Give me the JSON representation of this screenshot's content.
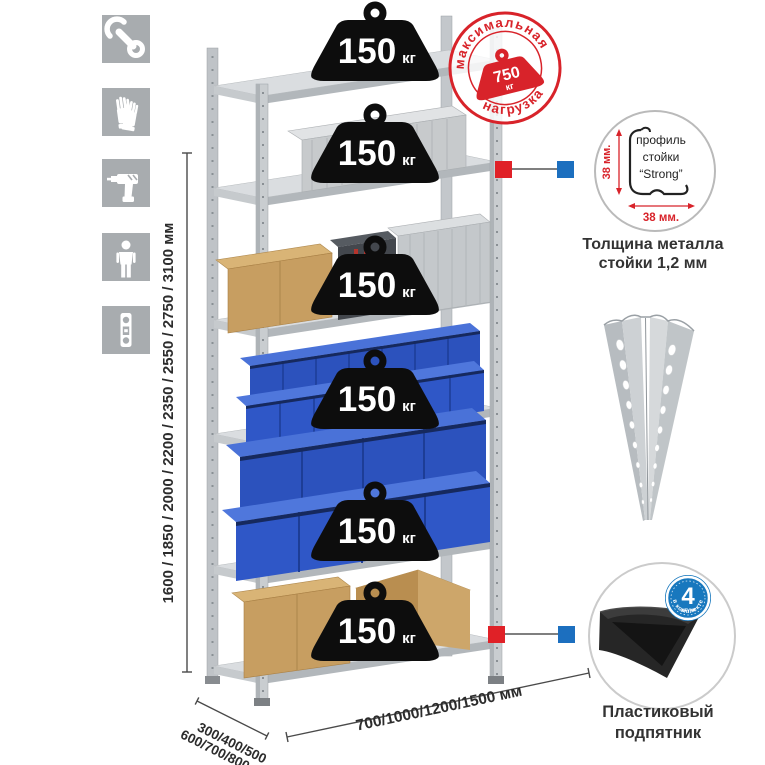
{
  "icons": [
    {
      "name": "wrench"
    },
    {
      "name": "work-gloves"
    },
    {
      "name": "drill"
    },
    {
      "name": "one-person-assembly"
    },
    {
      "name": "spirit-level"
    }
  ],
  "dimensions": {
    "height": "1600 / 1850 / 2000 / 2200 / 2350 / 2550 / 2750 / 3100 мм",
    "depth_line1": "300/400/500",
    "depth_line2": "600/700/800 мм",
    "width": "700/1000/1200/1500 мм"
  },
  "shelves": [
    {
      "load": "150",
      "unit": "кг"
    },
    {
      "load": "150",
      "unit": "кг"
    },
    {
      "load": "150",
      "unit": "кг"
    },
    {
      "load": "150",
      "unit": "кг"
    },
    {
      "load": "150",
      "unit": "кг"
    },
    {
      "load": "150",
      "unit": "кг"
    }
  ],
  "max_load_stamp": {
    "arc_top": "максимальная",
    "arc_bottom": "нагрузка",
    "value": "750",
    "unit": "кг"
  },
  "profile_callout": {
    "line1": "профиль",
    "line2": "стойки",
    "line3": "“Strong”",
    "dim_vertical": "38 мм.",
    "dim_horizontal": "38 мм.",
    "caption1": "Толщина металла",
    "caption2": "стойки 1,2 мм"
  },
  "foot_callout": {
    "badge_value": "4",
    "badge_unit": "штуки",
    "badge_arc": "в комплекте",
    "caption1": "Пластиковый",
    "caption2": "подпятник"
  },
  "colors": {
    "stamp_red": "#d8232a",
    "callout_red": "#e02127",
    "callout_blue": "#1c6fbf",
    "bin_blue": "#2f57c7",
    "icon_gray": "#a8acaf",
    "metal_light": "#dadde0",
    "text_dark": "#2c2c2c"
  }
}
